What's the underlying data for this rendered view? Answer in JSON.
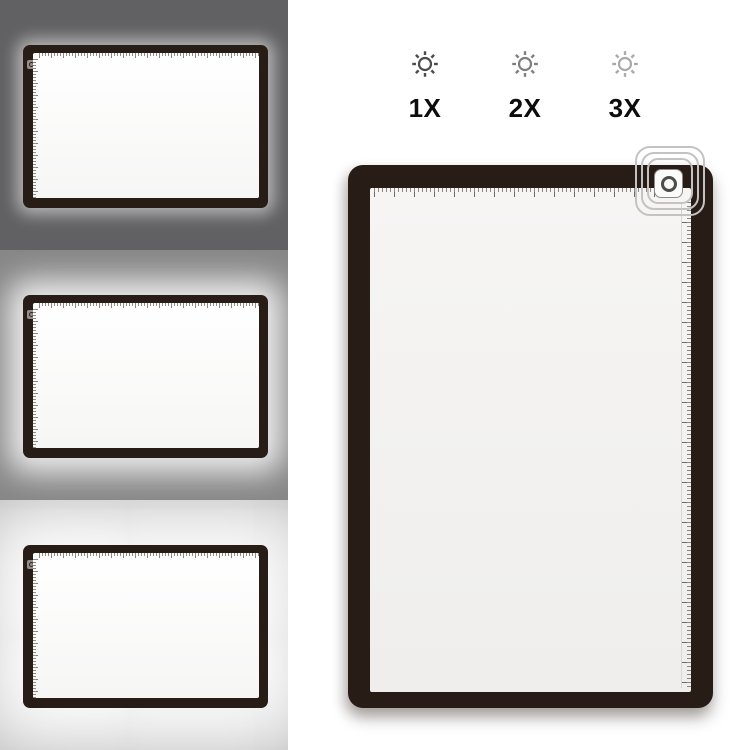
{
  "brightness_levels": [
    {
      "label": "1X",
      "icon": "sun-brightness-icon",
      "icon_color": "#4c4c4c"
    },
    {
      "label": "2X",
      "icon": "sun-brightness-icon",
      "icon_color": "#7f7f7f"
    },
    {
      "label": "3X",
      "icon": "sun-brightness-icon",
      "icon_color": "#aaaaaa"
    }
  ],
  "previews": [
    {
      "level": "1X",
      "background": "#616163",
      "glow": "low"
    },
    {
      "level": "2X",
      "background": "#878787",
      "glow": "medium"
    },
    {
      "level": "3X",
      "background": "#b0b0b0",
      "glow": "high"
    }
  ],
  "pad": {
    "frame_color": "#281c17",
    "screen_on_color": "#fdfdfc",
    "screen_off_color": "#f2f1f0",
    "power_button_icon": "power-touch-button",
    "callout_icon": "power-button-highlight-rings"
  }
}
